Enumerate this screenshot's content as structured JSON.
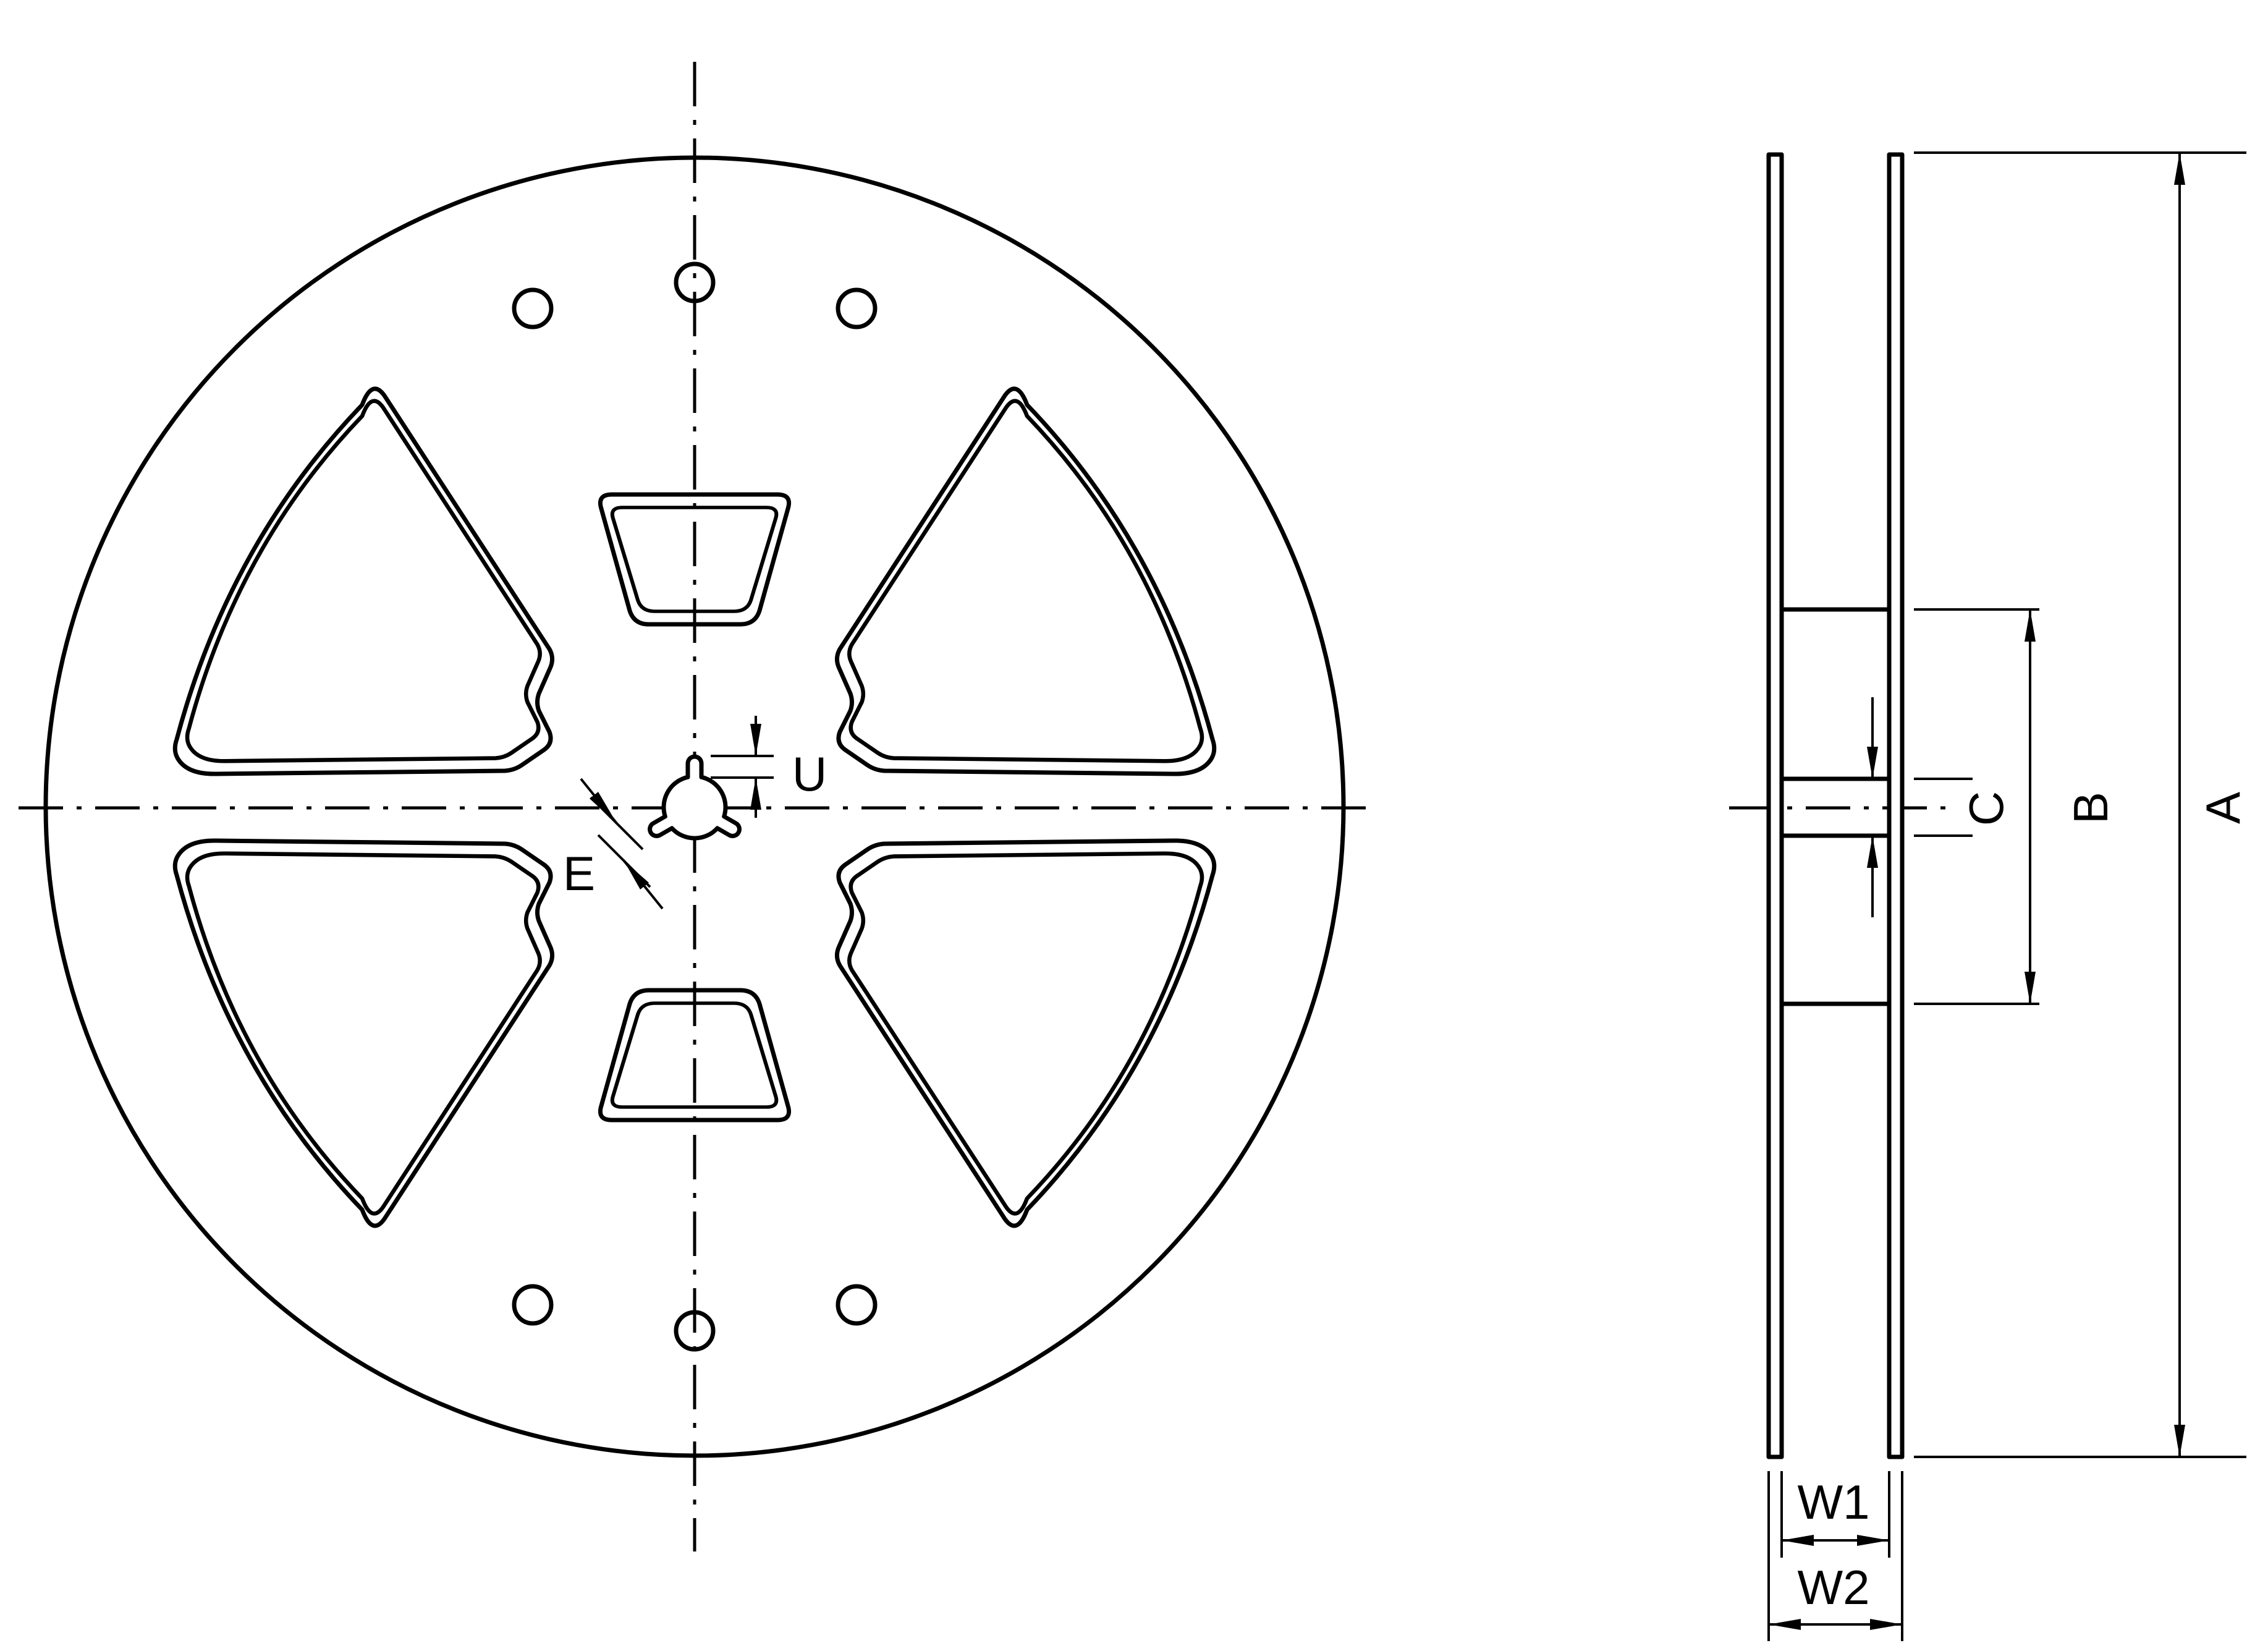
{
  "drawing": {
    "kind": "tape-reel-dimension-drawing",
    "colors": {
      "line": "#000000",
      "background": "#ffffff"
    },
    "front_view": {
      "dimension_labels": {
        "u": "U",
        "e": "E"
      }
    },
    "side_view": {
      "dimension_labels": {
        "c": "C",
        "b": "B",
        "a": "A",
        "w1": "W1",
        "w2": "W2"
      }
    }
  }
}
